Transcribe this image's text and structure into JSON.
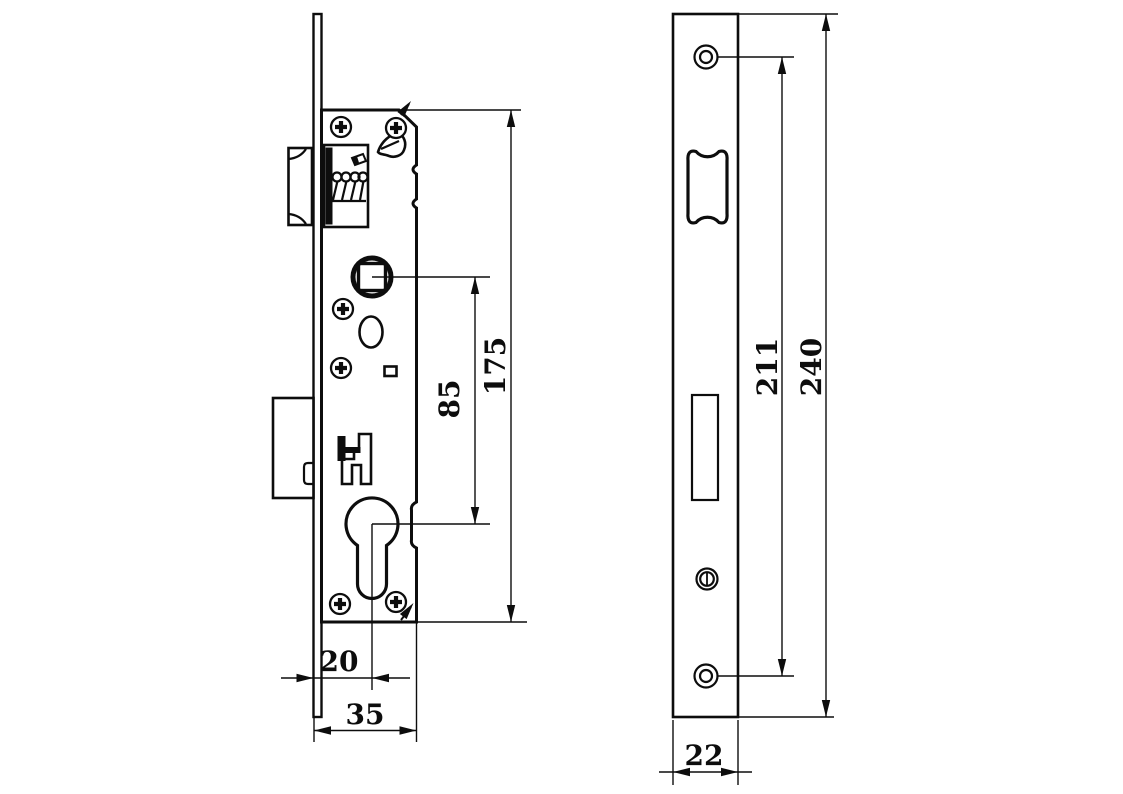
{
  "colors": {
    "ink": "#0d0d0d",
    "paper": "#ffffff"
  },
  "side_view": {
    "dims": {
      "case_height": "175",
      "spindle_to_cylinder": "85",
      "backset": "20",
      "case_depth": "35"
    }
  },
  "front_view": {
    "dims": {
      "screw_centers": "211",
      "plate_length": "240",
      "plate_width": "22"
    }
  }
}
